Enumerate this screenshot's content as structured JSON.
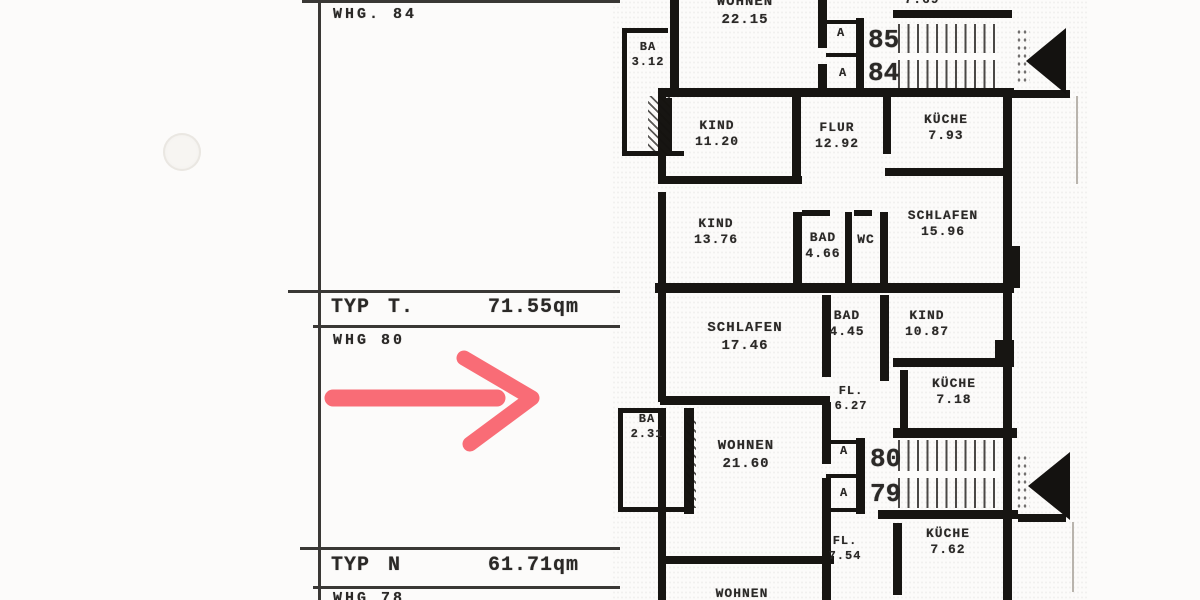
{
  "left_panel": {
    "whg_84": "WHG. 84",
    "typ_t": {
      "name": "TYP",
      "code": "T.",
      "area": "71.55qm"
    },
    "whg_80": "WHG 80",
    "typ_n": {
      "name": "TYP",
      "code": "N",
      "area": "61.71qm"
    },
    "whg_78": "WHG 78"
  },
  "annotation": {
    "arrow_color": "#f8525e"
  },
  "floorplan": {
    "rooms": [
      {
        "id": "wohnen-2215",
        "name": "WOHNEN",
        "area": "22.15",
        "x": 690,
        "y": -6,
        "w": 110,
        "fs": 14
      },
      {
        "id": "ba-312",
        "name": "BA",
        "area": "3.12",
        "x": 628,
        "y": 40,
        "w": 40,
        "fs": 12
      },
      {
        "id": "area-769",
        "name": "",
        "area": "7.69",
        "x": 892,
        "y": -8,
        "w": 60,
        "fs": 13
      },
      {
        "id": "kind-1120",
        "name": "KIND",
        "area": "11.20",
        "x": 685,
        "y": 118,
        "w": 64,
        "fs": 13
      },
      {
        "id": "flur-1292",
        "name": "FLUR",
        "area": "12.92",
        "x": 806,
        "y": 120,
        "w": 62,
        "fs": 13
      },
      {
        "id": "kueche-793",
        "name": "KÜCHE",
        "area": "7.93",
        "x": 908,
        "y": 112,
        "w": 76,
        "fs": 13
      },
      {
        "id": "kind-1376",
        "name": "KIND",
        "area": "13.76",
        "x": 684,
        "y": 216,
        "w": 64,
        "fs": 13
      },
      {
        "id": "bad-466",
        "name": "BAD",
        "area": "4.66",
        "x": 800,
        "y": 230,
        "w": 46,
        "fs": 13
      },
      {
        "id": "wc",
        "name": "WC",
        "area": "",
        "x": 850,
        "y": 232,
        "w": 32,
        "fs": 13
      },
      {
        "id": "schlafen-1596",
        "name": "SCHLAFEN",
        "area": "15.96",
        "x": 894,
        "y": 208,
        "w": 98,
        "fs": 13
      },
      {
        "id": "schlafen-1746",
        "name": "SCHLAFEN",
        "area": "17.46",
        "x": 694,
        "y": 320,
        "w": 102,
        "fs": 14
      },
      {
        "id": "bad-445",
        "name": "BAD",
        "area": "4.45",
        "x": 824,
        "y": 308,
        "w": 46,
        "fs": 13
      },
      {
        "id": "kind-1087",
        "name": "KIND",
        "area": "10.87",
        "x": 898,
        "y": 308,
        "w": 58,
        "fs": 13
      },
      {
        "id": "fl-627",
        "name": "FL.",
        "area": "6.27",
        "x": 830,
        "y": 384,
        "w": 42,
        "fs": 12
      },
      {
        "id": "kueche-718",
        "name": "KÜCHE",
        "area": "7.18",
        "x": 916,
        "y": 376,
        "w": 76,
        "fs": 13
      },
      {
        "id": "ba-231",
        "name": "BA",
        "area": "2.31",
        "x": 626,
        "y": 412,
        "w": 42,
        "fs": 12
      },
      {
        "id": "wohnen-2160",
        "name": "WOHNEN",
        "area": "21.60",
        "x": 700,
        "y": 438,
        "w": 92,
        "fs": 14
      },
      {
        "id": "fl-754",
        "name": "FL.",
        "area": "7.54",
        "x": 824,
        "y": 534,
        "w": 42,
        "fs": 12
      },
      {
        "id": "kueche-762",
        "name": "KÜCHE",
        "area": "7.62",
        "x": 910,
        "y": 526,
        "w": 76,
        "fs": 13
      },
      {
        "id": "wohnen-bottom",
        "name": "WOHNEN",
        "area": "",
        "x": 696,
        "y": 586,
        "w": 92,
        "fs": 13
      }
    ],
    "unit_numbers": [
      {
        "text": "85",
        "x": 868,
        "y": 27
      },
      {
        "text": "84",
        "x": 868,
        "y": 60
      },
      {
        "text": "80",
        "x": 870,
        "y": 446
      },
      {
        "text": "79",
        "x": 870,
        "y": 481
      }
    ],
    "door_labels": [
      {
        "text": "A",
        "x": 837,
        "y": 27
      },
      {
        "text": "A",
        "x": 839,
        "y": 67
      },
      {
        "text": "A",
        "x": 840,
        "y": 445
      },
      {
        "text": "A",
        "x": 840,
        "y": 487
      }
    ]
  }
}
